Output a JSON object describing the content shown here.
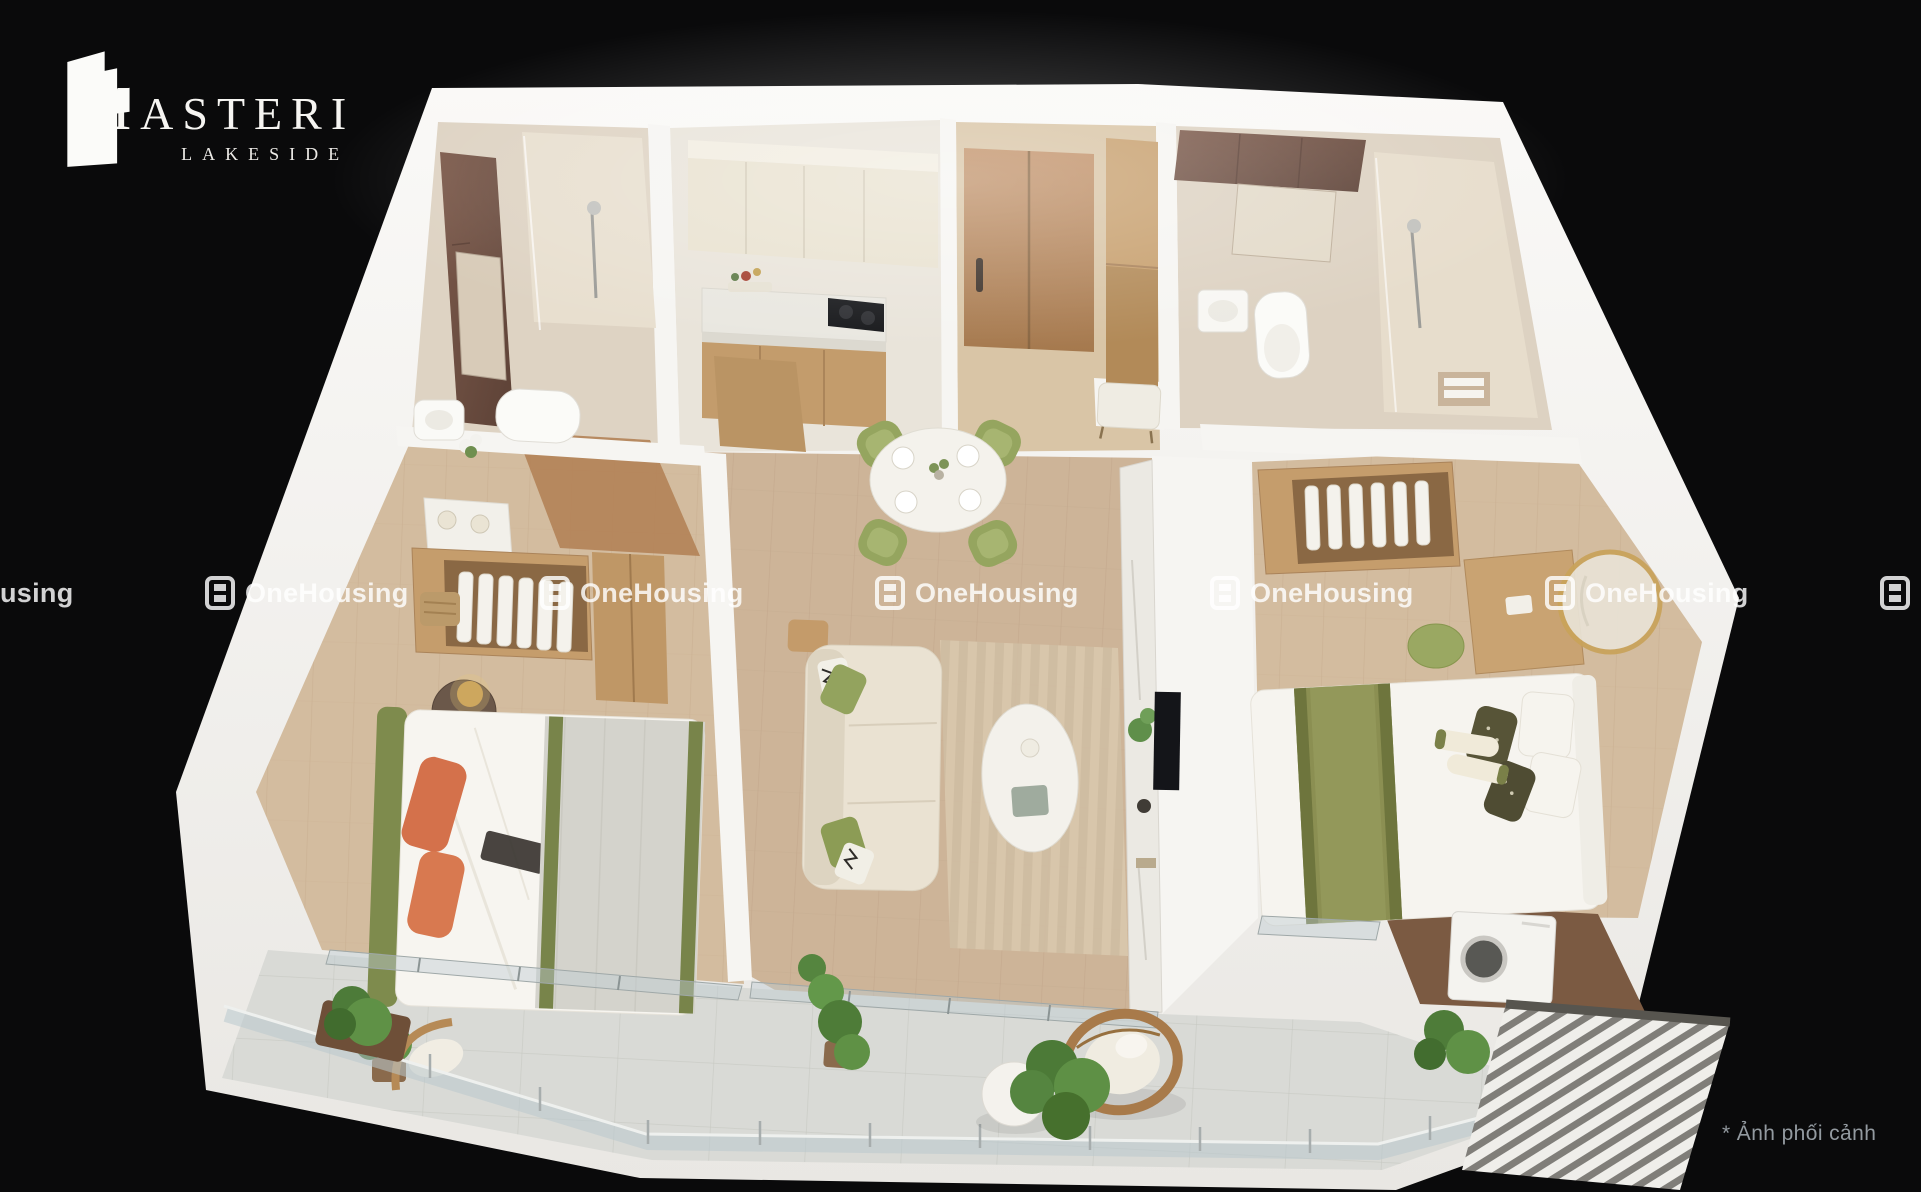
{
  "canvas": {
    "width": 1921,
    "height": 1192,
    "background": "#0a0a0b"
  },
  "brand": {
    "name": "MASTERI",
    "subtitle": "LAKESIDE",
    "icon": "masteri-building-icon",
    "color": "#f6f5f2"
  },
  "watermark": {
    "text": "OneHousing",
    "icon": "onehousing-logo-icon",
    "count": 7,
    "opacity": 0.82
  },
  "caption": {
    "text": "* Ảnh phối cảnh",
    "color": "#939aa0"
  },
  "scene": {
    "type": "3d-floor-plan-render",
    "subject": "furnished-apartment-isometric-cutaway",
    "rooms": [
      "bathroom-1",
      "kitchen",
      "entry-hall",
      "bathroom-2",
      "bedroom-1",
      "living-dining-room",
      "bedroom-2",
      "balcony",
      "laundry-nook"
    ],
    "palette": {
      "outer_wall": "#f4f3f0",
      "wood_floor": "#cdb498",
      "bedroom_floor": "#d3bc9f",
      "balcony_tile": "#d8d9d5",
      "bathroom_floor": "#ded3c3",
      "accent_marble_brown": "#6e4f44",
      "cabinet_wood": "#c49e6e",
      "sofa_cream": "#eae2d2",
      "chair_green": "#95a55f",
      "pillow_orange": "#d4714b",
      "throw_olive": "#78844a",
      "plant_green": "#5f9146"
    }
  }
}
